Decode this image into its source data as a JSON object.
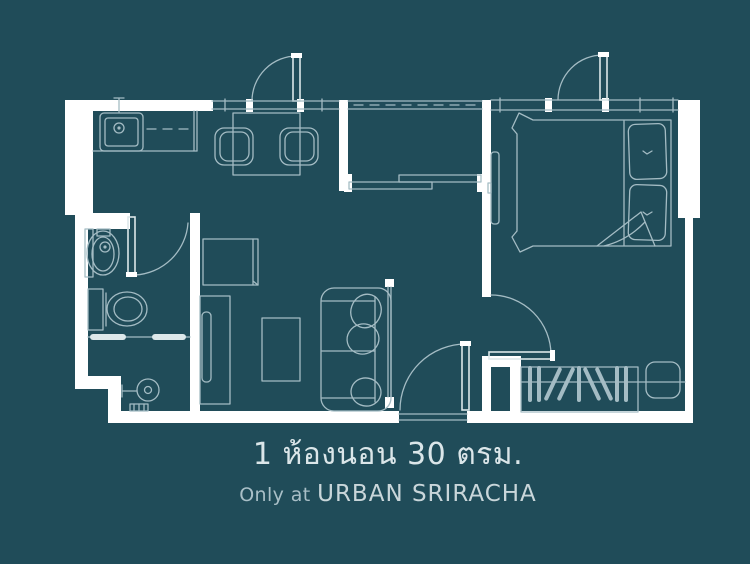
{
  "colors": {
    "background": "#204c59",
    "wall": "#ffffff",
    "line": "#a4bcc4",
    "line_bright": "#dde8ea",
    "title_text": "#dbe6e9",
    "subtitle_text": "#a9bfc7",
    "brand_text": "#c9d6da"
  },
  "caption": {
    "title": "1 ห้องนอน 30 ตรม.",
    "subtitle_prefix": "Only at",
    "subtitle_brand": "URBAN SRIRACHA"
  },
  "floor_plan": {
    "description": "one-bedroom 30 sqm condominium unit floor plan",
    "features": [
      "kitchen-sink",
      "kitchen-counter",
      "dining-table",
      "dining-chairs",
      "entry-door",
      "balcony-railing",
      "balcony-sliding-door",
      "double-bed",
      "pillows",
      "bedroom-tv",
      "wardrobe-hangers",
      "ac-unit",
      "bedroom-door",
      "hall-door",
      "glass-partition",
      "washbasin",
      "toilet",
      "shower",
      "floor-drain",
      "bathroom-door",
      "tv-cabinet",
      "refrigerator-cabinet",
      "coffee-table",
      "sofa"
    ]
  }
}
